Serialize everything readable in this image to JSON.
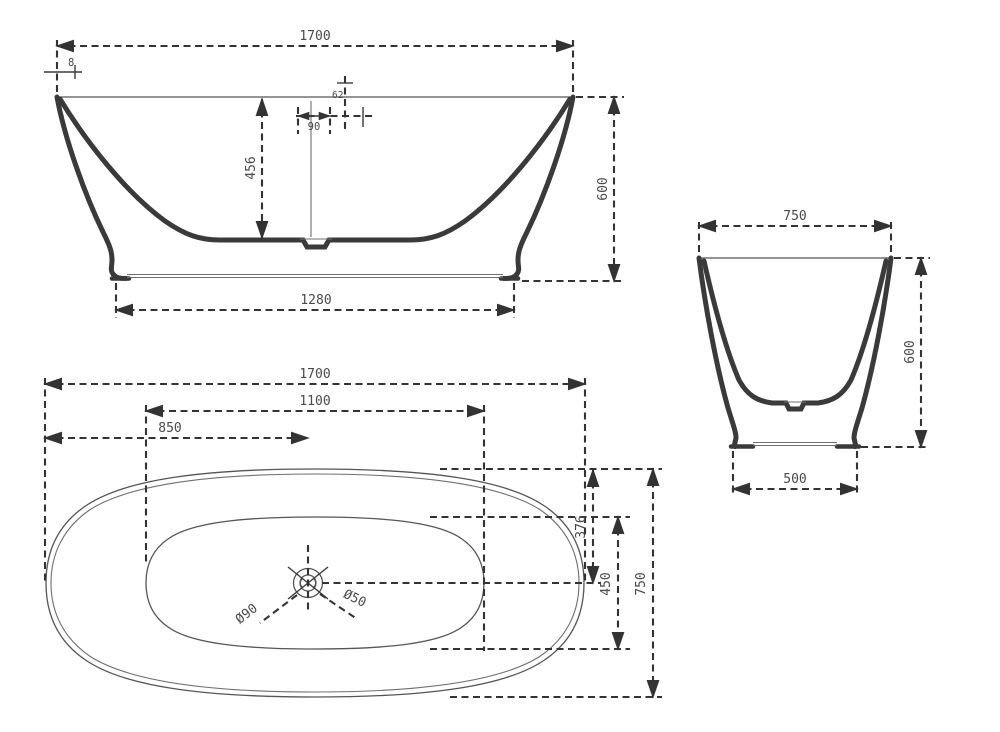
{
  "colors": {
    "ink": "#3a3a3a",
    "dim_ink": "#333333",
    "background": "#ffffff"
  },
  "views": {
    "front": {
      "overall_width": "1700",
      "rim_lip": "8",
      "overflow_offset": "62",
      "overflow_width": "90",
      "inner_depth": "456",
      "overall_height": "600",
      "base_length": "1280"
    },
    "side": {
      "overall_width": "750",
      "overall_height": "600",
      "base_width": "500"
    },
    "top": {
      "overall_length": "1700",
      "inner_length": "1100",
      "drain_from_end": "850",
      "drain_from_edge": "376",
      "inner_width": "450",
      "overall_width": "750",
      "drain_diameter": "Ø90",
      "outlet_diameter": "Ø50"
    }
  }
}
